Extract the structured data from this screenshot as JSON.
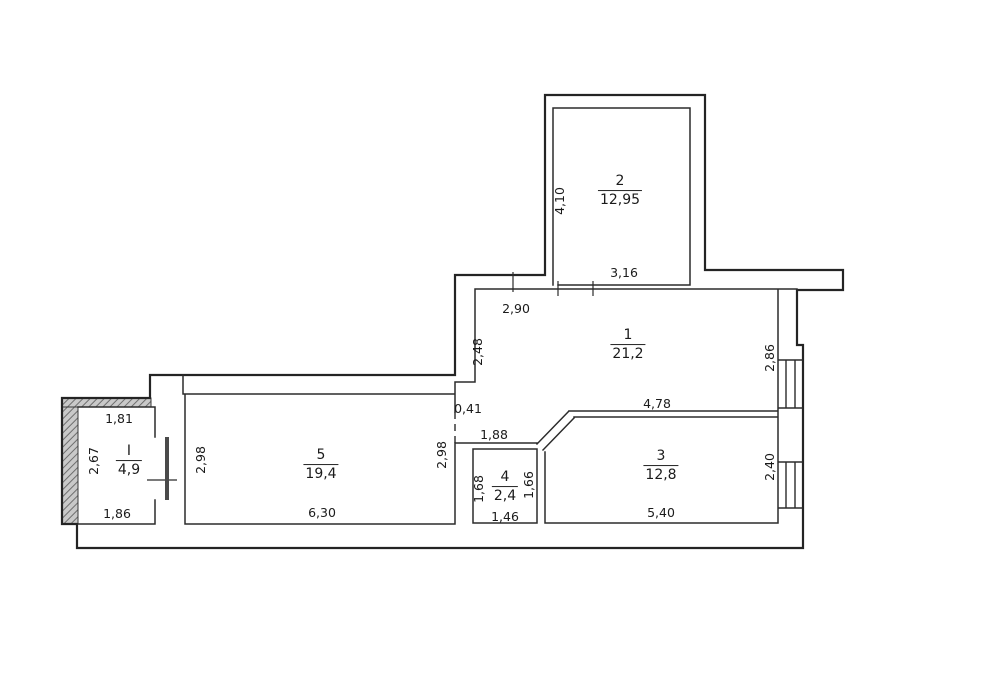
{
  "plan_type": "apartment-floor-plan",
  "colors": {
    "wall_line": "#242424",
    "thin_line": "#2b2b2b",
    "hatch_fill": "#c9c9c9",
    "hatch_stroke": "#6e6e6e",
    "door_leaf": "#4a4a4a",
    "background": "#ffffff"
  },
  "rooms": {
    "r1": {
      "number": "1",
      "area": "21,2",
      "dim_top": "2,90",
      "dim_left": "2,48",
      "dim_right": "2,86",
      "dim_bottom": "4,78"
    },
    "r2": {
      "number": "2",
      "area": "12,95",
      "dim_left": "4,10",
      "dim_bottom": "3,16"
    },
    "r3": {
      "number": "3",
      "area": "12,8",
      "dim_right": "2,40",
      "dim_bottom": "5,40"
    },
    "r4": {
      "number": "4",
      "area": "2,4",
      "dim_top": "1,88",
      "dim_left": "1,68",
      "dim_right": "1,66",
      "dim_bottom": "1,46"
    },
    "r5": {
      "number": "5",
      "area": "19,4",
      "dim_left": "2,98",
      "dim_right": "2,98",
      "dim_bottom": "6,30"
    },
    "rI": {
      "number": "I",
      "area": "4,9",
      "dim_top": "1,81",
      "dim_left": "2,67",
      "dim_bottom": "1,86"
    }
  },
  "annotations": {
    "wall_stub": "0,41"
  }
}
